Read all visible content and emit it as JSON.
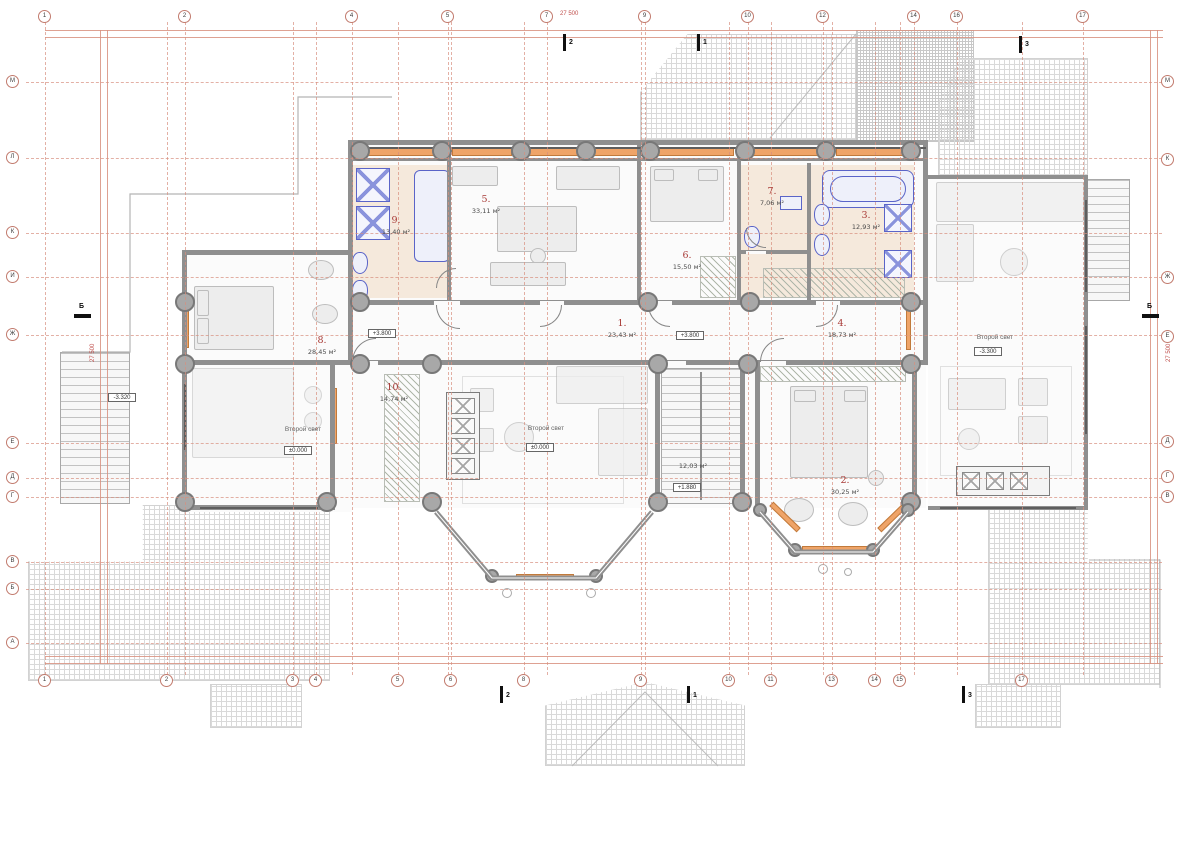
{
  "title": "Floor plan (second level)",
  "axes": {
    "top": [
      "1",
      "2",
      "4",
      "5",
      "7",
      "9",
      "10",
      "12",
      "14",
      "16",
      "17"
    ],
    "bottom": [
      "1",
      "2",
      "3",
      "4",
      "5",
      "6",
      "8",
      "9",
      "10",
      "11",
      "13",
      "14",
      "15",
      "17"
    ],
    "left": [
      "М",
      "Л",
      "К",
      "И",
      "Ж",
      "Е",
      "Д",
      "Г",
      "В",
      "Б",
      "А"
    ],
    "right": [
      "М",
      "К",
      "Ж",
      "Е",
      "Д",
      "Г",
      "В"
    ]
  },
  "rooms": [
    {
      "number": "1.",
      "area": "23,43 м²"
    },
    {
      "number": "2.",
      "area": "30,25 м²"
    },
    {
      "number": "3.",
      "area": "12,93 м²"
    },
    {
      "number": "4.",
      "area": "18,73 м²"
    },
    {
      "number": "5.",
      "area": "33,11 м²"
    },
    {
      "number": "6.",
      "area": "15,50 м²"
    },
    {
      "number": "7.",
      "area": "7,06 м²"
    },
    {
      "number": "8.",
      "area": "28,45 м²"
    },
    {
      "number": "9.",
      "area": "13,40 м²"
    },
    {
      "number": "10.",
      "area": "14,74 м²"
    }
  ],
  "stair_area": "12,03 м²",
  "labels": {
    "second_light": "Второй свет"
  },
  "elevations": [
    {
      "text": "+3.800"
    },
    {
      "text": "+3.800"
    },
    {
      "text": "±0.000"
    },
    {
      "text": "±0.000"
    },
    {
      "text": "-3.300"
    },
    {
      "text": "+1.880"
    },
    {
      "text": "-3.320"
    }
  ],
  "dims": {
    "top": "27 500",
    "left": "27 500",
    "right": "27 500"
  },
  "sections": {
    "top": [
      "2",
      "1",
      "3"
    ],
    "bottom": [
      "2",
      "1",
      "3"
    ],
    "side": "Б"
  },
  "colors": {
    "grid_red": "#d8907f",
    "wall_gray": "#8f8f8f",
    "radiator_orange": "#efa468",
    "plumbing_blue": "#5a64c8",
    "room_number_red": "#a83a36",
    "bathroom_floor": "#f5e9dc"
  }
}
